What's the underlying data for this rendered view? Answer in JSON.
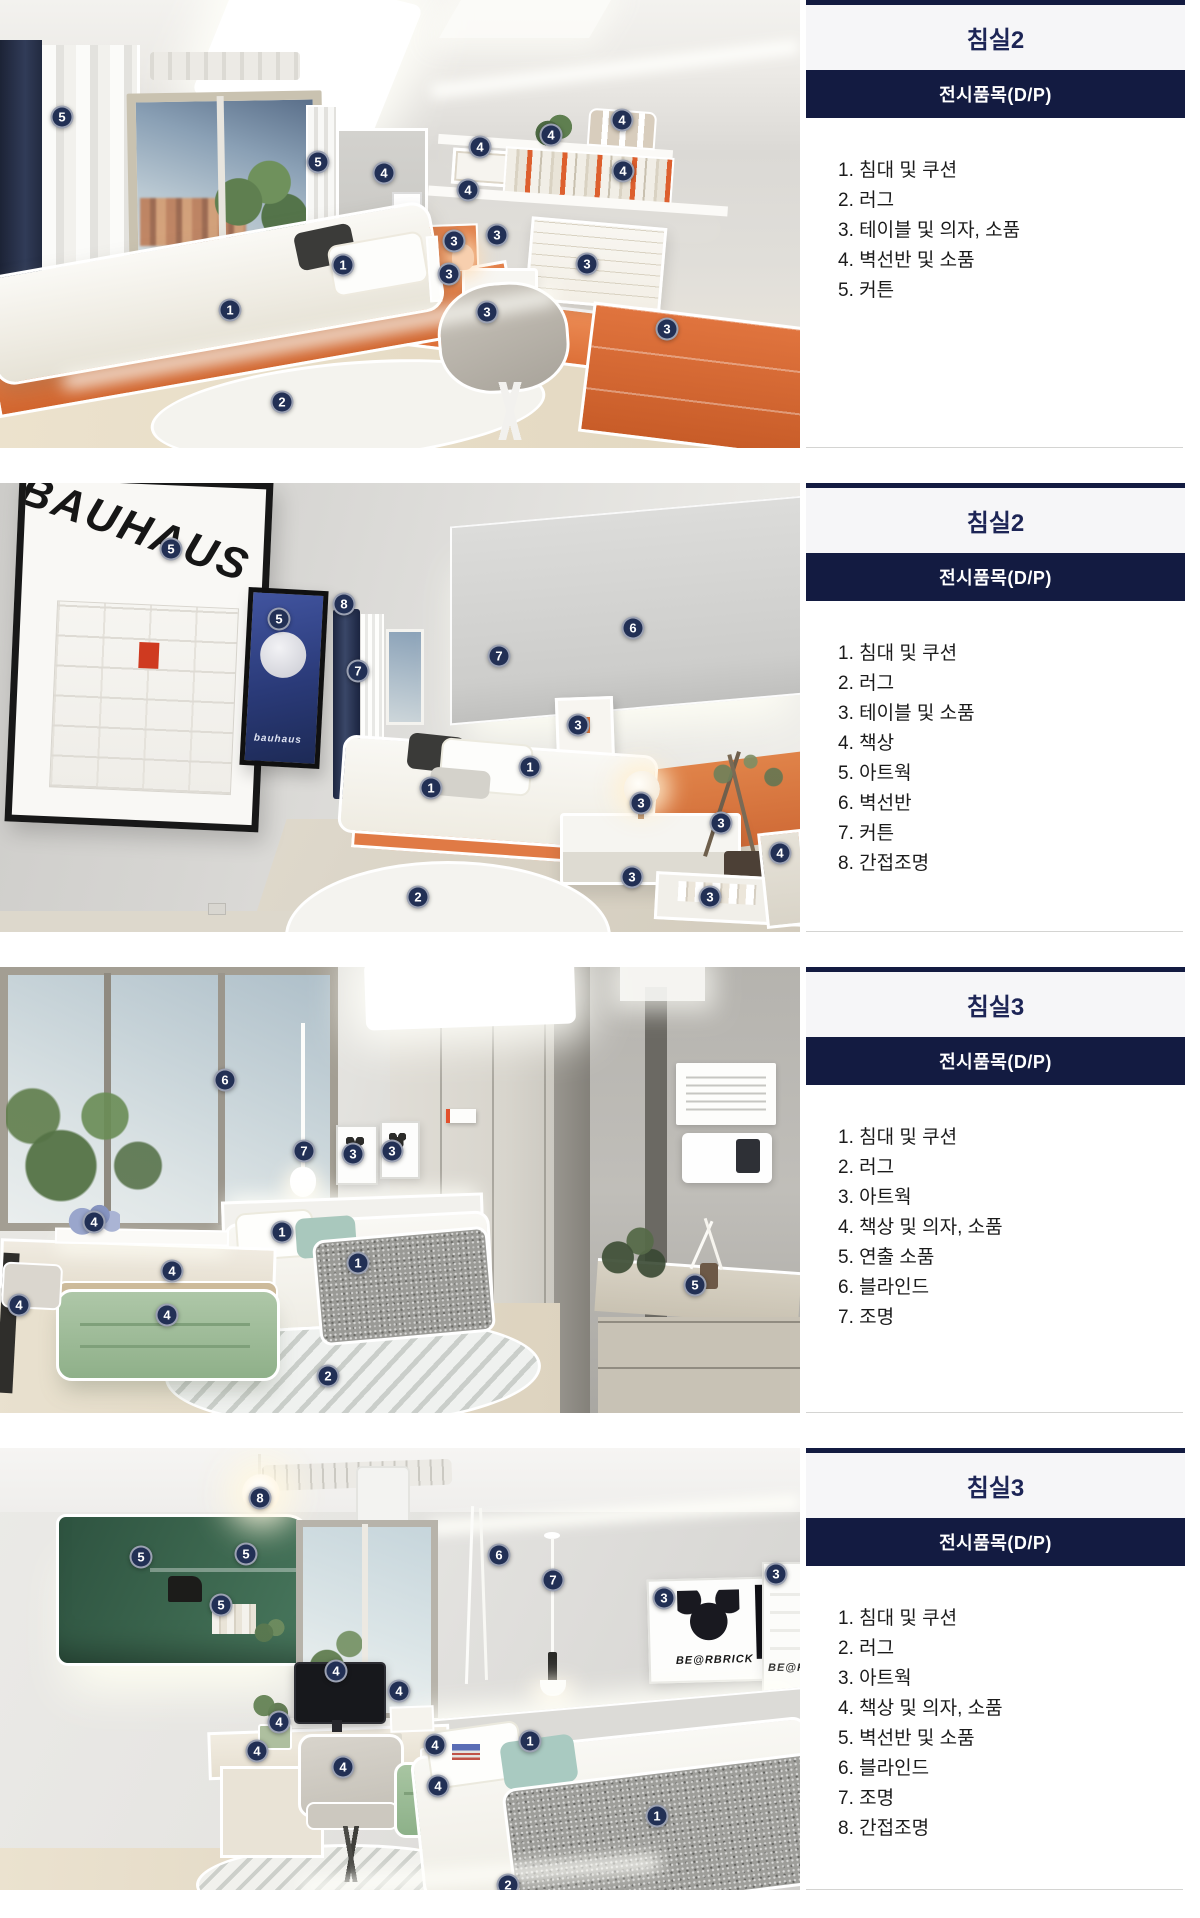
{
  "colors": {
    "navy_bar": "#131b41",
    "title_text": "#1d2556",
    "marker_bg": "#223055",
    "separator": "#d4d4d2",
    "accent_orange": "#dd7a44",
    "accent_dark_green": "#3c674f",
    "accent_sage_green": "#9bbb97"
  },
  "rows": [
    {
      "title": "침실2",
      "header": "전시품목(D/P)",
      "items": [
        "1. 침대 및 쿠션",
        "2. 러그",
        "3. 테이블 및 의자, 소품",
        "4. 벽선반 및 소품",
        "5. 커튼"
      ],
      "markers": [
        {
          "n": "5",
          "x": 62,
          "y": 117
        },
        {
          "n": "5",
          "x": 318,
          "y": 162
        },
        {
          "n": "4",
          "x": 384,
          "y": 173
        },
        {
          "n": "4",
          "x": 480,
          "y": 147
        },
        {
          "n": "4",
          "x": 551,
          "y": 135
        },
        {
          "n": "4",
          "x": 622,
          "y": 120
        },
        {
          "n": "4",
          "x": 623,
          "y": 171
        },
        {
          "n": "4",
          "x": 468,
          "y": 190
        },
        {
          "n": "3",
          "x": 454,
          "y": 241
        },
        {
          "n": "3",
          "x": 497,
          "y": 235
        },
        {
          "n": "3",
          "x": 449,
          "y": 274
        },
        {
          "n": "3",
          "x": 587,
          "y": 264
        },
        {
          "n": "3",
          "x": 487,
          "y": 312
        },
        {
          "n": "3",
          "x": 667,
          "y": 329
        },
        {
          "n": "1",
          "x": 343,
          "y": 265
        },
        {
          "n": "1",
          "x": 230,
          "y": 310
        },
        {
          "n": "2",
          "x": 282,
          "y": 402
        }
      ]
    },
    {
      "title": "침실2",
      "header": "전시품목(D/P)",
      "items": [
        "1. 침대 및 쿠션",
        "2. 러그",
        "3. 테이블 및 소품",
        "4. 책상",
        "5. 아트웍",
        "6. 벽선반",
        "7. 커튼",
        "8. 간접조명"
      ],
      "art": {
        "poster_main": "BAUHAUS",
        "poster_small": "bauhaus"
      },
      "markers": [
        {
          "n": "5",
          "x": 171,
          "y": 66
        },
        {
          "n": "5",
          "x": 279,
          "y": 136
        },
        {
          "n": "8",
          "x": 344,
          "y": 121
        },
        {
          "n": "7",
          "x": 358,
          "y": 188
        },
        {
          "n": "7",
          "x": 499,
          "y": 173
        },
        {
          "n": "6",
          "x": 633,
          "y": 145
        },
        {
          "n": "3",
          "x": 578,
          "y": 242
        },
        {
          "n": "1",
          "x": 530,
          "y": 284
        },
        {
          "n": "1",
          "x": 431,
          "y": 305
        },
        {
          "n": "3",
          "x": 641,
          "y": 320
        },
        {
          "n": "3",
          "x": 721,
          "y": 340
        },
        {
          "n": "4",
          "x": 780,
          "y": 370
        },
        {
          "n": "3",
          "x": 632,
          "y": 394
        },
        {
          "n": "3",
          "x": 710,
          "y": 414
        },
        {
          "n": "2",
          "x": 418,
          "y": 414
        }
      ]
    },
    {
      "title": "침실3",
      "header": "전시품목(D/P)",
      "items": [
        "1. 침대 및 쿠션",
        "2. 러그",
        "3. 아트웍",
        "4. 책상 및 의자, 소품",
        "5. 연출 소품",
        "6. 블라인드",
        "7. 조명"
      ],
      "markers": [
        {
          "n": "6",
          "x": 225,
          "y": 113
        },
        {
          "n": "7",
          "x": 304,
          "y": 184
        },
        {
          "n": "3",
          "x": 353,
          "y": 187
        },
        {
          "n": "3",
          "x": 392,
          "y": 184
        },
        {
          "n": "4",
          "x": 94,
          "y": 255
        },
        {
          "n": "1",
          "x": 282,
          "y": 265
        },
        {
          "n": "1",
          "x": 358,
          "y": 296
        },
        {
          "n": "4",
          "x": 172,
          "y": 304
        },
        {
          "n": "4",
          "x": 19,
          "y": 338
        },
        {
          "n": "4",
          "x": 167,
          "y": 348
        },
        {
          "n": "2",
          "x": 328,
          "y": 409
        },
        {
          "n": "5",
          "x": 695,
          "y": 318
        }
      ]
    },
    {
      "title": "침실3",
      "header": "전시품목(D/P)",
      "items": [
        "1. 침대 및 쿠션",
        "2. 러그",
        "3. 아트웍",
        "4. 책상 및 의자, 소품",
        "5. 벽선반 및 소품",
        "6. 블라인드",
        "7. 조명",
        "8. 간접조명"
      ],
      "art": {
        "poster1": "BE@RBRICK",
        "poster2": "BE@RBRICK"
      },
      "markers": [
        {
          "n": "8",
          "x": 260,
          "y": 50
        },
        {
          "n": "5",
          "x": 141,
          "y": 109
        },
        {
          "n": "5",
          "x": 246,
          "y": 106
        },
        {
          "n": "5",
          "x": 221,
          "y": 157
        },
        {
          "n": "6",
          "x": 499,
          "y": 107
        },
        {
          "n": "7",
          "x": 553,
          "y": 132
        },
        {
          "n": "3",
          "x": 664,
          "y": 150
        },
        {
          "n": "3",
          "x": 776,
          "y": 126
        },
        {
          "n": "4",
          "x": 336,
          "y": 223
        },
        {
          "n": "4",
          "x": 399,
          "y": 243
        },
        {
          "n": "4",
          "x": 279,
          "y": 274
        },
        {
          "n": "4",
          "x": 257,
          "y": 303
        },
        {
          "n": "4",
          "x": 343,
          "y": 319
        },
        {
          "n": "4",
          "x": 435,
          "y": 297
        },
        {
          "n": "4",
          "x": 438,
          "y": 338
        },
        {
          "n": "1",
          "x": 530,
          "y": 293
        },
        {
          "n": "1",
          "x": 657,
          "y": 368
        },
        {
          "n": "2",
          "x": 508,
          "y": 437
        }
      ]
    }
  ]
}
